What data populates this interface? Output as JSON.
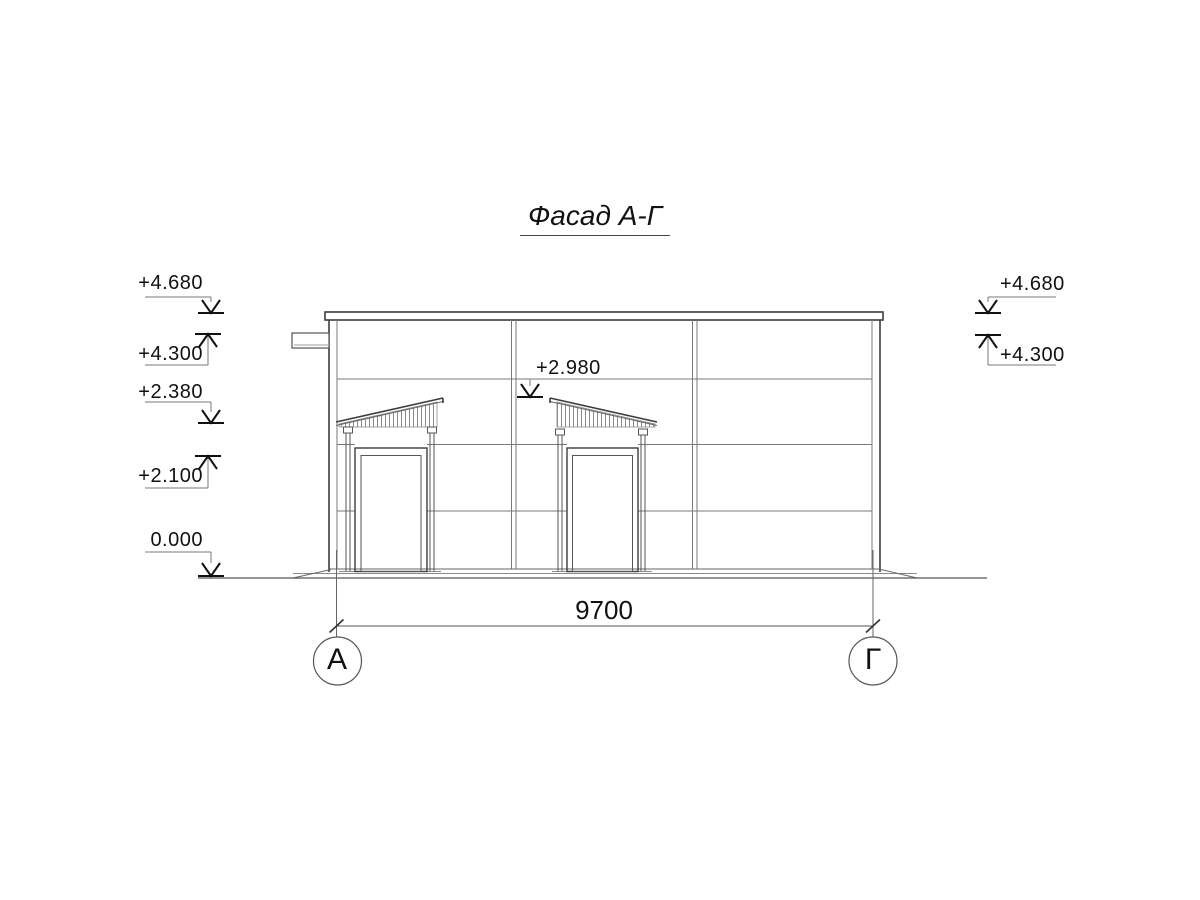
{
  "title": "Фасад А-Г",
  "facade": {
    "elevation_marks_left": [
      "+4.680",
      "+4.300",
      "+2.380",
      "+2.100",
      "0.000"
    ],
    "elevation_marks_right": [
      "+4.680",
      "+4.300"
    ],
    "elevation_mark_canopy": "+2.980",
    "dimension_width": "9700",
    "axis_left": "А",
    "axis_right": "Г"
  }
}
